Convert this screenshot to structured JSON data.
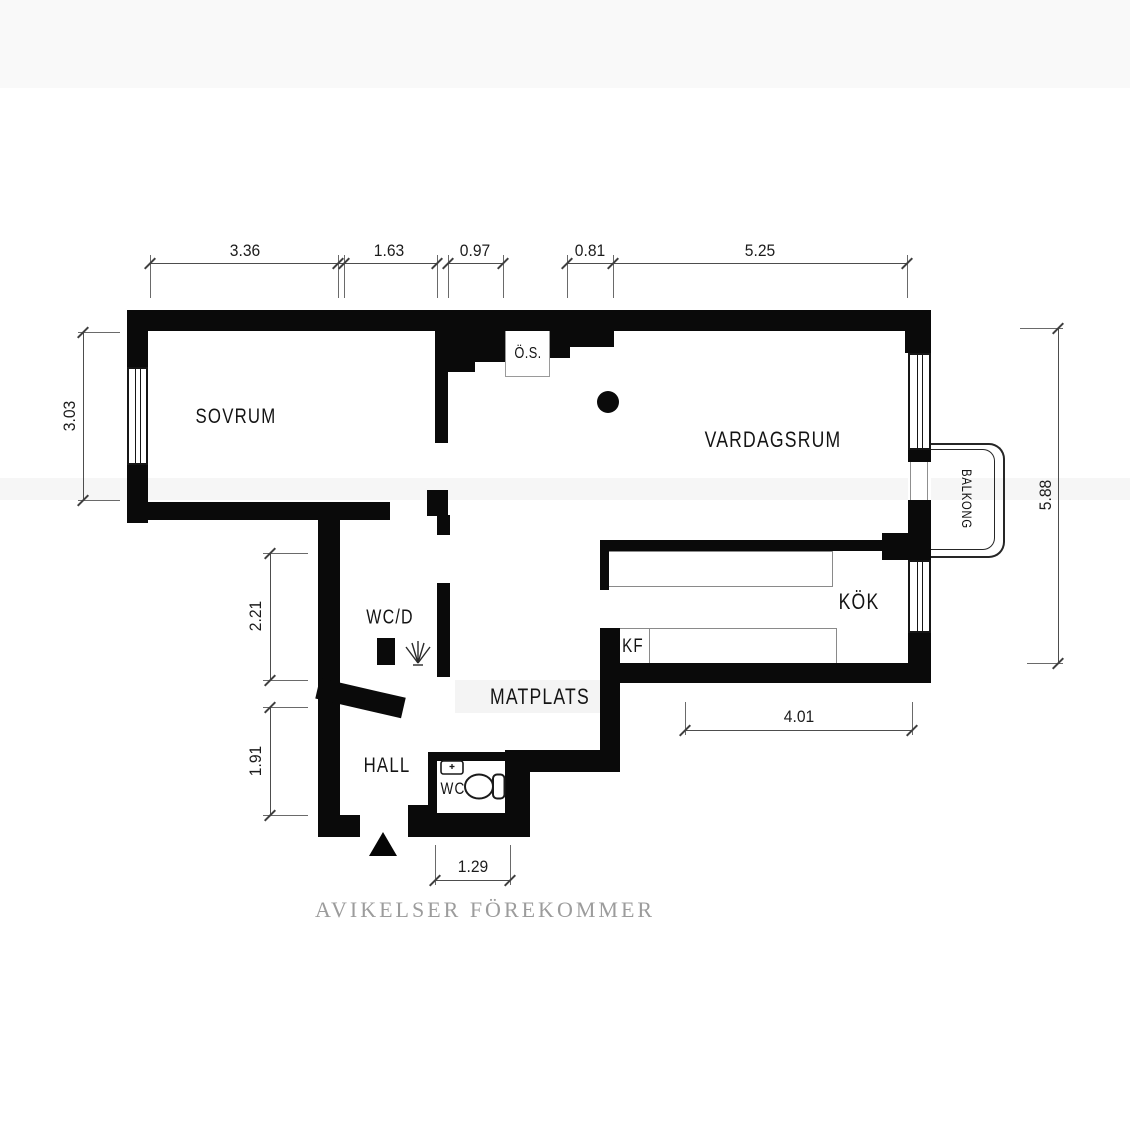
{
  "rooms": {
    "sovrum": {
      "label": "SOVRUM"
    },
    "vardagsrum": {
      "label": "VARDAGSRUM"
    },
    "kok": {
      "label": "KÖK"
    },
    "kf": {
      "label": "KF"
    },
    "os": {
      "label": "Ö.S."
    },
    "wcd": {
      "label": "WC/D"
    },
    "matplats": {
      "label": "MATPLATS"
    },
    "hall": {
      "label": "HALL"
    },
    "wc": {
      "label": "WC"
    },
    "balkong": {
      "label": "BALKONG"
    }
  },
  "dimensions": {
    "top": {
      "d1": "3.36",
      "d2": "1.63",
      "d3": "0.97",
      "d4": "0.81",
      "d5": "5.25"
    },
    "left": {
      "d1": "3.03",
      "d2": "2.21",
      "d3": "1.91"
    },
    "right": {
      "d1": "5.88"
    },
    "bottom": {
      "d1": "4.01",
      "d2": "1.29"
    }
  },
  "footer": {
    "disclaimer": "AVIKELSER FÖREKOMMER"
  },
  "icons": {
    "entrance-arrow-icon": "black triangle pointing up at entrance door",
    "shower-icon": "spray fan symbol in WC/D",
    "sink-icon": "small washbasin rectangle in WC",
    "toilet-icon": "toilet seen from above in WC",
    "vent-icon": "filled black circle in living room"
  },
  "colors": {
    "wall": "#0a0a0a",
    "dimension_line": "#4d4d4d",
    "footer_text": "#9c9c9c"
  }
}
